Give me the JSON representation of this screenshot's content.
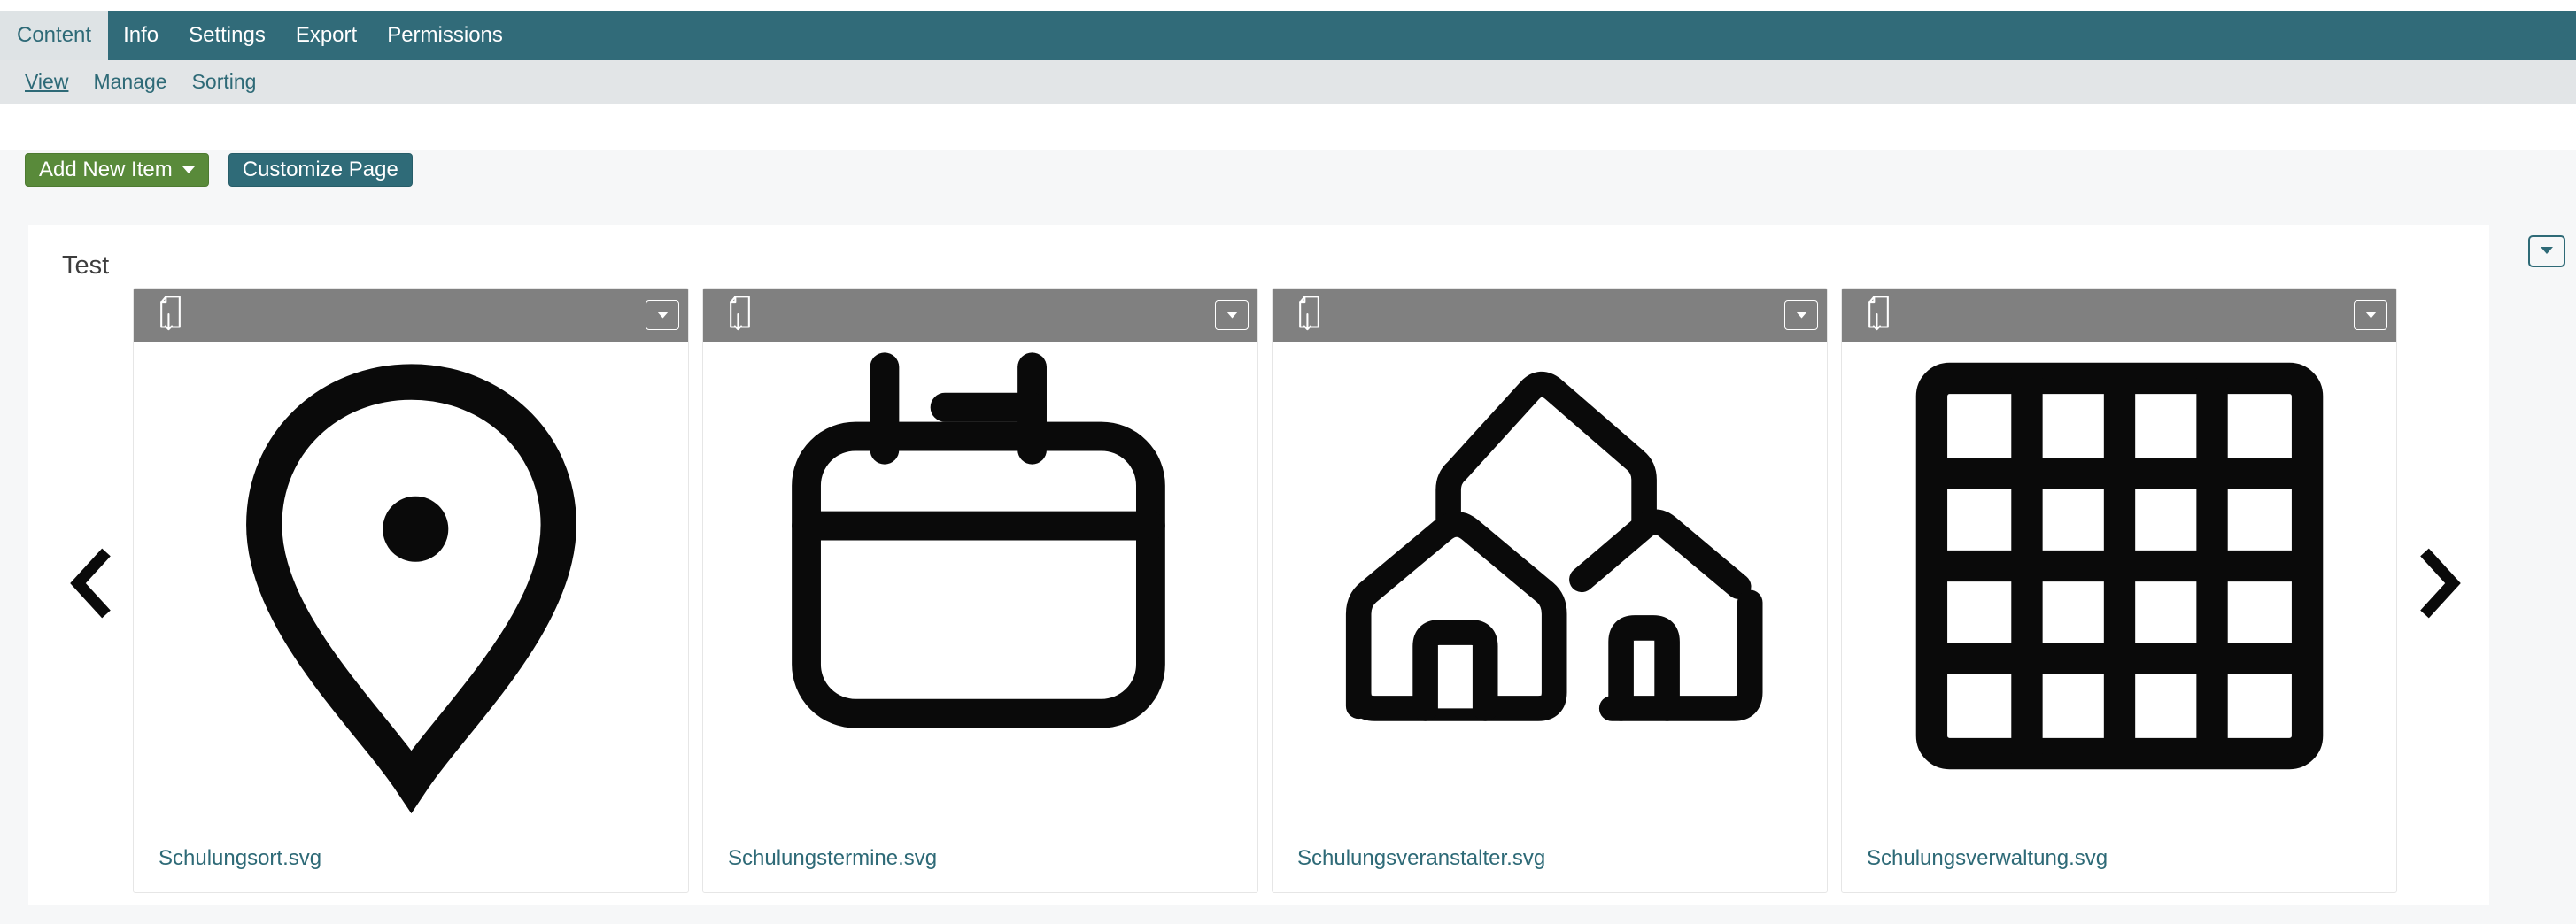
{
  "tabbar": {
    "tabs": [
      {
        "label": "Content",
        "active": true
      },
      {
        "label": "Info",
        "active": false
      },
      {
        "label": "Settings",
        "active": false
      },
      {
        "label": "Export",
        "active": false
      },
      {
        "label": "Permissions",
        "active": false
      }
    ]
  },
  "subnav": {
    "links": [
      {
        "label": "View",
        "current": true
      },
      {
        "label": "Manage",
        "current": false
      },
      {
        "label": "Sorting",
        "current": false
      }
    ]
  },
  "actions": {
    "add_new_item_label": "Add New Item",
    "customize_page_label": "Customize Page"
  },
  "section": {
    "title": "Test"
  },
  "carousel": {
    "cards": [
      {
        "filename": "Schulungsort.svg",
        "icon": "location-pin"
      },
      {
        "filename": "Schulungstermine.svg",
        "icon": "calendar"
      },
      {
        "filename": "Schulungsveranstalter.svg",
        "icon": "buildings"
      },
      {
        "filename": "Schulungsverwaltung.svg",
        "icon": "grid-4x4"
      }
    ]
  },
  "colors": {
    "toolbar_teal": "#316b79",
    "accent_teal": "#2e6a77",
    "button_green": "#598a3a",
    "card_header_gray": "#808080",
    "page_background": "#f6f7f8",
    "icon_black": "#0a0a0a"
  }
}
